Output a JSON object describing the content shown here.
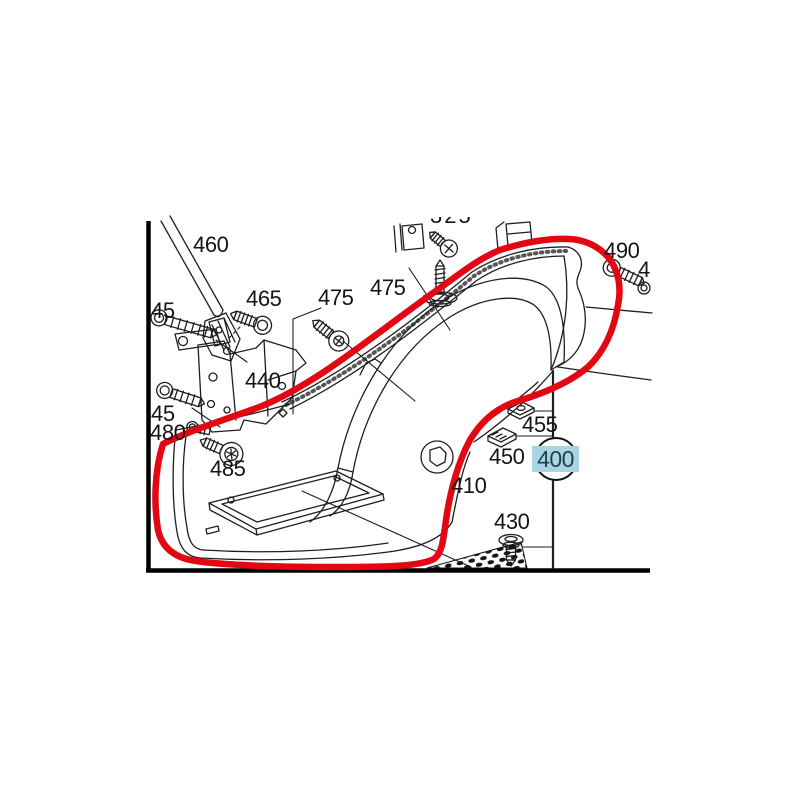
{
  "diagram": {
    "kind": "vehicle-parts-exploded-diagram",
    "selected_part": "400"
  },
  "labels": {
    "l460": "460",
    "l465": "465",
    "l475a": "475",
    "l475b": "475",
    "l490": "490",
    "l4": "4",
    "l440": "440",
    "l445a": "45",
    "l445b": "45",
    "l480": "480",
    "l485": "485",
    "l455": "455",
    "l450": "450",
    "l410": "410",
    "l430": "430",
    "l325": "325",
    "callout": "400"
  },
  "callout": {
    "value": "400",
    "highlight_color": "#a9d5e3",
    "text_color": "#1d3f4e",
    "circle_stroke": "#111111"
  },
  "colors": {
    "background": "#ffffff",
    "line_black": "#1f1f1f",
    "outline_red": "#e30613",
    "callout_highlight": "#a9d5e3"
  },
  "icons": [
    {
      "name": "strut-rod-icon",
      "for_label": "460"
    },
    {
      "name": "hex-bolt-icon",
      "for_label": "465"
    },
    {
      "name": "torx-screw-icon",
      "for_label": "475"
    },
    {
      "name": "flat-head-screw-icon",
      "for_label": "475"
    },
    {
      "name": "hex-bolt-icon",
      "for_label": "490"
    },
    {
      "name": "ring-nut-icon",
      "for_label": "4"
    },
    {
      "name": "mounting-bracket-icon",
      "for_label": "440"
    },
    {
      "name": "flange-bolt-icon",
      "for_label": "445"
    },
    {
      "name": "flange-bolt-icon",
      "for_label": "445"
    },
    {
      "name": "pan-screw-icon",
      "for_label": "480"
    },
    {
      "name": "torx-screw-icon",
      "for_label": "485"
    },
    {
      "name": "clip-nut-icon",
      "for_label": "455"
    },
    {
      "name": "cage-nut-icon",
      "for_label": "450"
    },
    {
      "name": "tapping-screw-icon",
      "for_label": "430"
    },
    {
      "name": "cross-screw-icon",
      "for_label": "325"
    },
    {
      "name": "retainer-clip-icon",
      "for_label": "325"
    }
  ]
}
